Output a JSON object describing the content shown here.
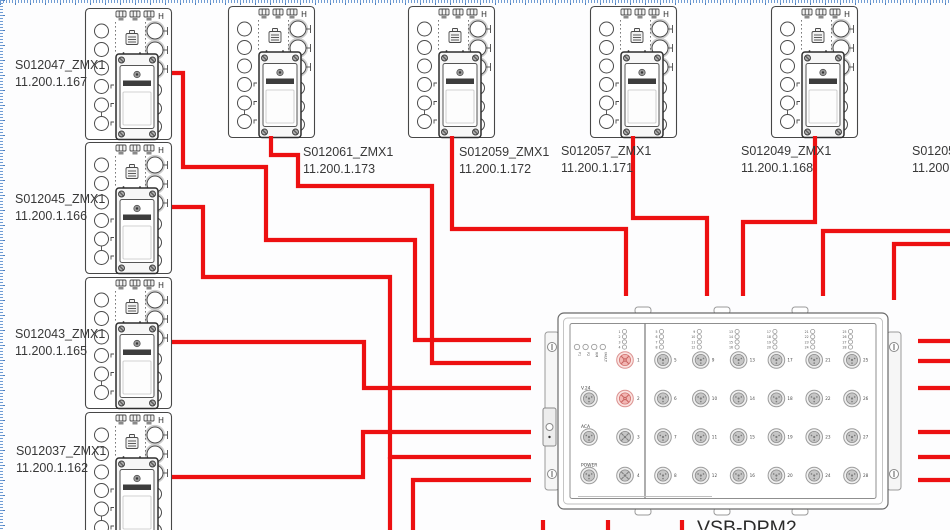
{
  "colors": {
    "wire": "#ed1011",
    "outline": "#474747",
    "highlight_fill": "#f2b6b3",
    "highlight_stroke": "#d37370",
    "ruler_tick": "#6f9cd4",
    "background": "#fdfdfe"
  },
  "zmx": {
    "corner_glyph": "H"
  },
  "devices": [
    {
      "name": "S012047_ZMX1",
      "ip": "11.200.1.167",
      "x": 85,
      "y": 8,
      "label": {
        "x": 15,
        "y": 57
      }
    },
    {
      "name": "S012045_ZMX1",
      "ip": "11.200.1.166",
      "x": 85,
      "y": 142,
      "label": {
        "x": 15,
        "y": 191
      }
    },
    {
      "name": "S012043_ZMX1",
      "ip": "11.200.1.165",
      "x": 85,
      "y": 277,
      "label": {
        "x": 15,
        "y": 326
      }
    },
    {
      "name": "S012037_ZMX1",
      "ip": "11.200.1.162",
      "x": 85,
      "y": 412,
      "label": {
        "x": 16,
        "y": 443
      }
    },
    {
      "name": "S012061_ZMX1",
      "ip": "11.200.1.173",
      "x": 228,
      "y": 6,
      "label": {
        "x": 303,
        "y": 144
      }
    },
    {
      "name": "S012059_ZMX1",
      "ip": "11.200.1.172",
      "x": 408,
      "y": 6,
      "label": {
        "x": 459,
        "y": 144
      }
    },
    {
      "name": "S012057_ZMX1",
      "ip": "11.200.1.171",
      "x": 590,
      "y": 6,
      "label": {
        "x": 561,
        "y": 143
      }
    },
    {
      "name": "S012049_ZMX1",
      "ip": "11.200.1.168",
      "x": 771,
      "y": 6,
      "label": {
        "x": 741,
        "y": 143
      }
    },
    {
      "name": "S012053",
      "ip": "11.200.1",
      "x": null,
      "y": null,
      "label": {
        "x": 912,
        "y": 143
      }
    }
  ],
  "hub": {
    "title": "VSB-DPM2",
    "x": 558,
    "y": 313,
    "w": 330,
    "h": 196,
    "title_pos": {
      "x": 697,
      "y": 517
    },
    "status_labels": [
      "P1",
      "P2",
      "RM",
      "FAULT"
    ],
    "aux_labels": [
      "V.24",
      "ACA",
      "POWER"
    ],
    "left_ports": [
      "1",
      "2",
      "3",
      "4"
    ],
    "highlighted_ports": [
      "1",
      "2"
    ],
    "grid_columns": [
      [
        "5",
        "6",
        "7",
        "8"
      ],
      [
        "9",
        "10",
        "11",
        "12"
      ],
      [
        "13",
        "14",
        "15",
        "16"
      ],
      [
        "17",
        "18",
        "19",
        "20"
      ],
      [
        "21",
        "22",
        "23",
        "24"
      ],
      [
        "25",
        "26",
        "27",
        "28"
      ]
    ]
  },
  "wires": [
    {
      "id": "S012047",
      "points": [
        [
          172,
          73
        ],
        [
          183,
          73
        ],
        [
          183,
          167
        ],
        [
          266,
          167
        ],
        [
          266,
          240
        ],
        [
          415,
          240
        ],
        [
          415,
          340
        ],
        [
          531,
          340
        ]
      ]
    },
    {
      "id": "S012045",
      "points": [
        [
          172,
          207
        ],
        [
          203,
          207
        ],
        [
          203,
          277
        ],
        [
          390,
          277
        ],
        [
          390,
          457
        ],
        [
          531,
          457
        ]
      ]
    },
    {
      "id": "S012061",
      "points": [
        [
          271,
          136
        ],
        [
          271,
          155
        ],
        [
          298,
          155
        ],
        [
          298,
          186
        ],
        [
          432,
          186
        ],
        [
          432,
          363
        ],
        [
          531,
          363
        ]
      ]
    },
    {
      "id": "S012043",
      "points": [
        [
          172,
          342
        ],
        [
          364,
          342
        ],
        [
          364,
          388
        ],
        [
          531,
          388
        ]
      ]
    },
    {
      "id": "S012037",
      "points": [
        [
          172,
          477
        ],
        [
          363,
          477
        ],
        [
          363,
          432
        ],
        [
          531,
          432
        ]
      ]
    },
    {
      "id": "S012059",
      "points": [
        [
          452,
          136
        ],
        [
          452,
          229
        ],
        [
          626,
          229
        ],
        [
          626,
          296
        ]
      ]
    },
    {
      "id": "S012057",
      "points": [
        [
          633,
          136
        ],
        [
          633,
          218
        ],
        [
          707,
          218
        ],
        [
          707,
          296
        ]
      ]
    },
    {
      "id": "S012049",
      "points": [
        [
          815,
          136
        ],
        [
          815,
          222
        ],
        [
          743,
          222
        ],
        [
          743,
          296
        ]
      ]
    },
    {
      "id": "right-top-a",
      "points": [
        [
          950,
          231
        ],
        [
          823,
          231
        ],
        [
          823,
          296
        ]
      ]
    },
    {
      "id": "right-top-b",
      "points": [
        [
          950,
          244
        ],
        [
          894,
          244
        ],
        [
          894,
          300
        ]
      ]
    },
    {
      "id": "bottom-left-a",
      "points": [
        [
          390,
          457
        ],
        [
          390,
          530
        ]
      ]
    },
    {
      "id": "bottom-left-b",
      "points": [
        [
          531,
          480
        ],
        [
          413,
          480
        ],
        [
          413,
          530
        ]
      ]
    },
    {
      "id": "right-stub-1",
      "points": [
        [
          918,
          341
        ],
        [
          950,
          341
        ]
      ]
    },
    {
      "id": "right-stub-2",
      "points": [
        [
          918,
          361
        ],
        [
          950,
          361
        ]
      ]
    },
    {
      "id": "right-stub-3",
      "points": [
        [
          918,
          388
        ],
        [
          950,
          388
        ]
      ]
    },
    {
      "id": "right-stub-4",
      "points": [
        [
          918,
          432
        ],
        [
          950,
          432
        ]
      ]
    },
    {
      "id": "right-stub-5",
      "points": [
        [
          918,
          457
        ],
        [
          950,
          457
        ]
      ]
    },
    {
      "id": "right-stub-6",
      "points": [
        [
          918,
          480
        ],
        [
          950,
          480
        ]
      ]
    },
    {
      "id": "bottom-stub-1",
      "points": [
        [
          543,
          520
        ],
        [
          543,
          530
        ]
      ]
    },
    {
      "id": "bottom-stub-2",
      "points": [
        [
          608,
          520
        ],
        [
          608,
          530
        ]
      ]
    },
    {
      "id": "bottom-stub-3",
      "points": [
        [
          682,
          520
        ],
        [
          682,
          530
        ]
      ]
    }
  ]
}
